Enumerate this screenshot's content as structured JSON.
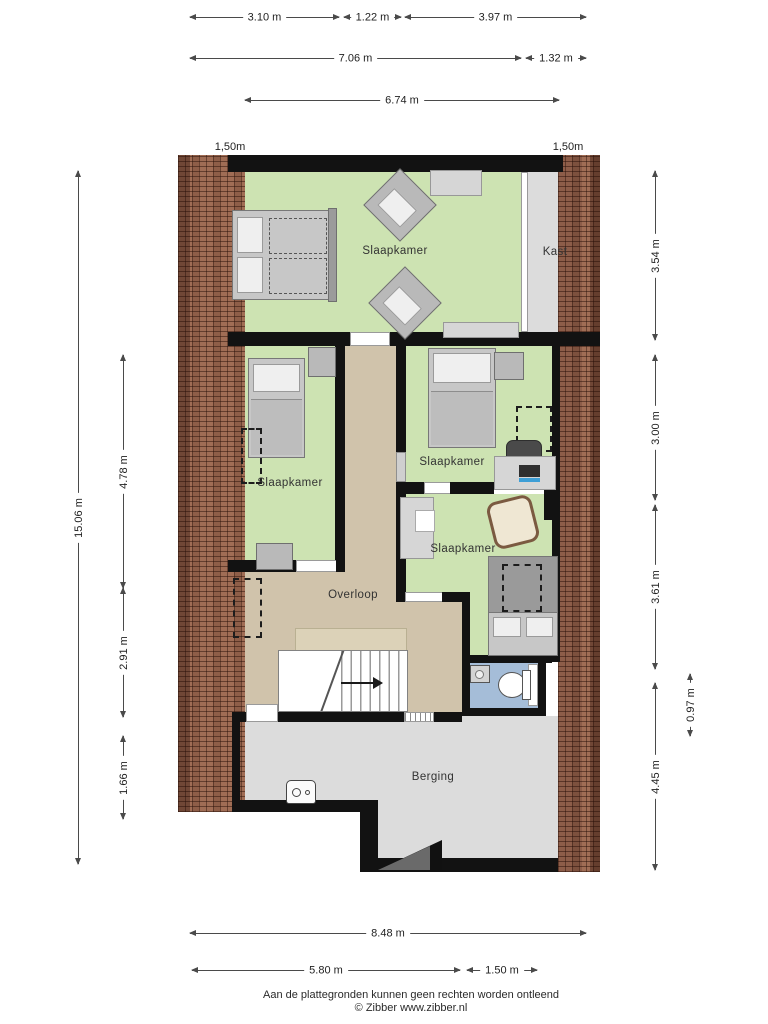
{
  "rooms": {
    "slaapkamer_main": "Slaapkamer",
    "kast": "Kast",
    "slaapkamer_left": "Slaapkamer",
    "slaapkamer_mid": "Slaapkamer",
    "slaapkamer_bottom": "Slaapkamer",
    "overloop": "Overloop",
    "berging": "Berging"
  },
  "roof": {
    "left_label": "1,50m",
    "right_label": "1,50m"
  },
  "dims": {
    "w1": "3.10 m",
    "w2": "1.22 m",
    "w3": "3.97 m",
    "w4": "7.06 m",
    "w5": "1.32 m",
    "w6": "6.74 m",
    "h_total": "15.06 m",
    "h1": "4.78 m",
    "h2": "2.91 m",
    "h3": "1.66 m",
    "r1": "3.54 m",
    "r2": "3.00 m",
    "r3": "3.61 m",
    "r4": "4.45 m",
    "r5": "0.97 m",
    "b1": "8.48 m",
    "b2": "5.80 m",
    "b3": "1.50 m"
  },
  "footer": {
    "disclaimer": "Aan de plattegronden kunnen geen rechten worden ontleend",
    "copyright": "© Zibber www.zibber.nl"
  },
  "colors": {
    "floor_room": "#cde3b2",
    "floor_hall": "#d0c3ab",
    "floor_storage": "#dcdcdc",
    "floor_toilet": "#a5bdd8",
    "wall": "#121212",
    "roof_tile": "#a06d55"
  }
}
